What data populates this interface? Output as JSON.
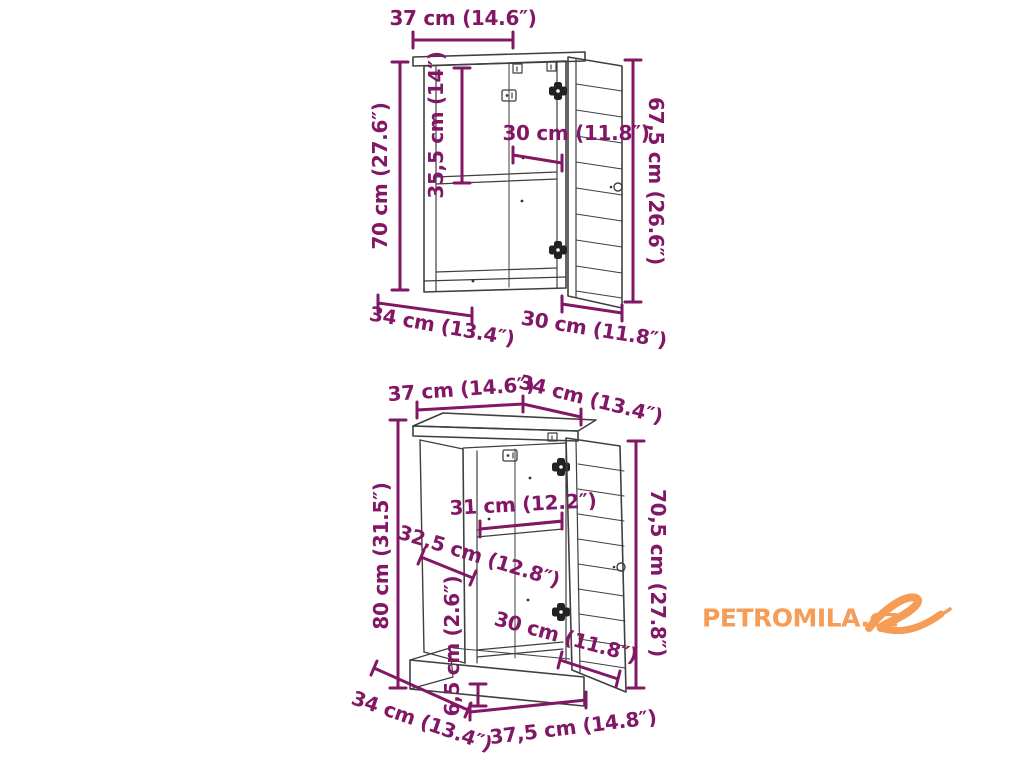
{
  "cabinets": {
    "top": {
      "width_top": "37 cm (14.6″)",
      "height_left": "70 cm (27.6″)",
      "inner_height": "35,5 cm (14″)",
      "inner_width": "30 cm (11.8″)",
      "height_right": "67,5 cm (26.6″)",
      "depth_bottom": "34 cm (13.4″)",
      "door_width_bottom": "30 cm (11.8″)"
    },
    "bottom": {
      "width_top": "37 cm (14.6″)",
      "depth_top": "34 cm (13.4″)",
      "height_left": "80 cm (31.5″)",
      "shelf_width": "31 cm (12.2″)",
      "compartment_height": "32,5 cm (12.8″)",
      "height_right": "70,5 cm (27.8″)",
      "plinth_height": "6,5 cm (2.6″)",
      "door_width": "30 cm (11.8″)",
      "depth_bottom": "34 cm (13.4″)",
      "width_bottom": "37,5 cm (14.8″)"
    }
  },
  "watermark": {
    "brand": "PETROMILA.cz"
  },
  "colors": {
    "dimension": "#821766",
    "drawing": "#3F3F3F",
    "watermark": "#F59C56",
    "background": "#FFFFFF"
  }
}
